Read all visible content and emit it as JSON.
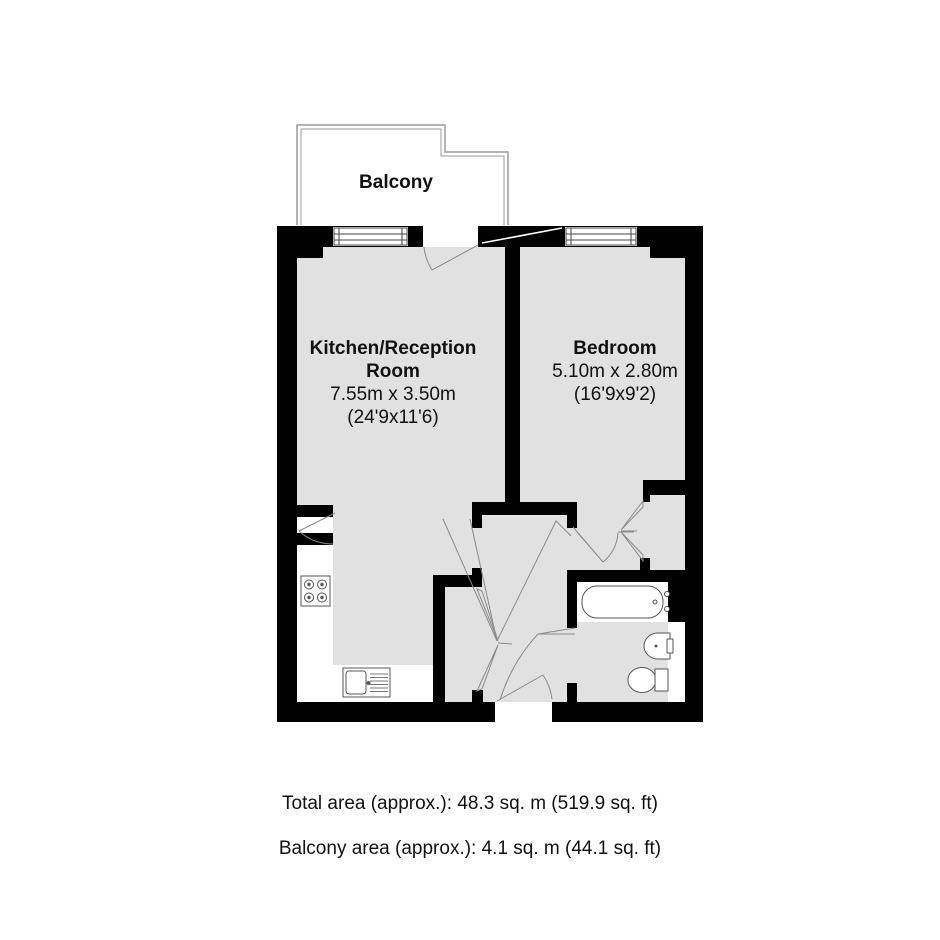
{
  "plan": {
    "type": "apartment-floorplan",
    "colors": {
      "wall": "#000000",
      "floor": "#e1e1e1",
      "background": "#ffffff",
      "linework": "#888888"
    },
    "balcony": {
      "label": "Balcony"
    },
    "rooms": [
      {
        "name": "Kitchen/Reception Room",
        "name_line1": "Kitchen/Reception",
        "name_line2": "Room",
        "dimensions_metric": "7.55m x 3.50m",
        "dimensions_imperial": "(24'9x11'6)"
      },
      {
        "name": "Bedroom",
        "dimensions_metric": "5.10m x 2.80m",
        "dimensions_imperial": "(16'9x9'2)"
      }
    ],
    "fixtures": {
      "bathtub": "bathtub",
      "wash_basin": "wash-basin",
      "toilet": "toilet",
      "hob": "four-burner-hob",
      "kitchen_sink": "kitchen-sink-with-drainer",
      "wardrobe": "built-in-wardrobe-bifold-doors",
      "hall_cupboard": "hall-cupboard-bifold-doors",
      "windows": "double-glazed-windows"
    },
    "summary": {
      "total_area": "Total area (approx.): 48.3 sq. m (519.9 sq. ft)",
      "balcony_area": "Balcony area (approx.): 4.1 sq. m (44.1 sq. ft)"
    }
  }
}
